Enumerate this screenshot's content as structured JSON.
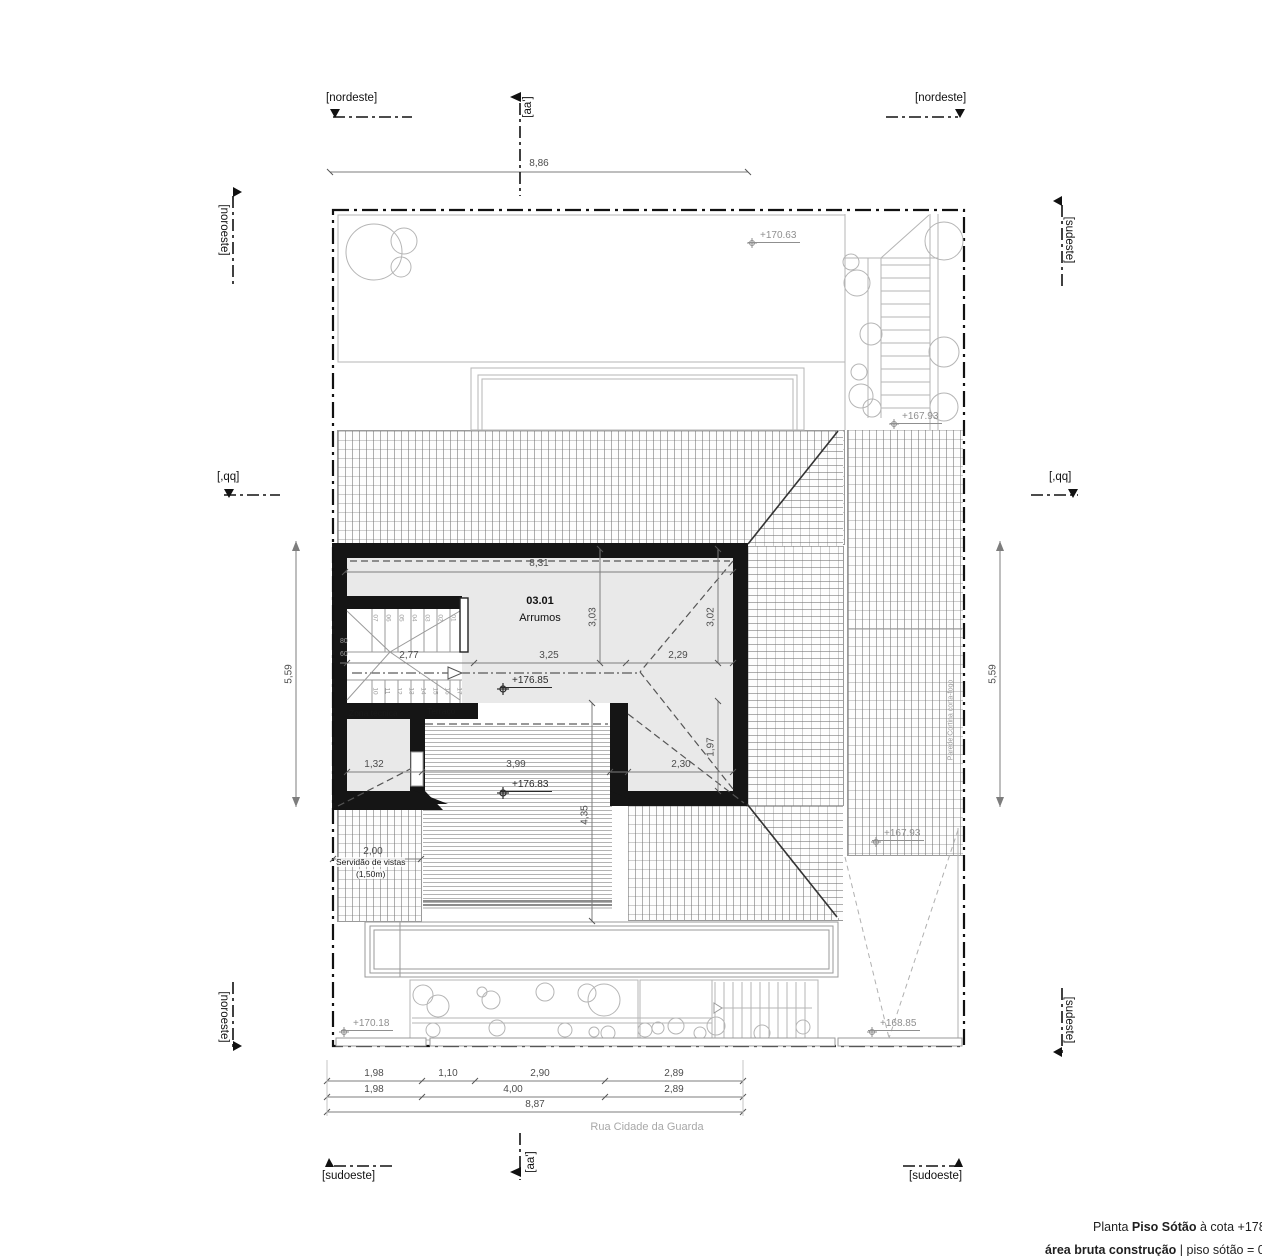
{
  "sections": {
    "nordeste": "[nordeste]",
    "aa": "[aa']",
    "noroeste": "[noroeste]",
    "sudeste": "[sudeste]",
    "qq": "[,qq]",
    "sudoeste": "[sudoeste]"
  },
  "rooms": {
    "number": "03.01",
    "name": "Arrumos",
    "zona": "Zona técnica",
    "terraco": "Terraço",
    "servidao_line1": "Servidão de vistas",
    "servidao_line2": "(1,50m)",
    "firewall": "Parede Cortina corta-fogo"
  },
  "levels": {
    "garden_top": "+170.63",
    "stair_right": "+167.93",
    "attic": "+176.85",
    "terrace": "+176.83",
    "ramp_top": "+167.93",
    "garden_bottom": "+170.18",
    "ramp_bottom": "+168.85"
  },
  "dimensions": {
    "site_width": "8,86",
    "side_left": "5,59",
    "side_right": "5,59",
    "room_width": "8,31",
    "room_depth_left": "3,03",
    "room_depth_right": "3,02",
    "stair_width": "2,77",
    "room_mid": "3,25",
    "room_right": "2,29",
    "zona": "1,32",
    "terrace_width": "3,99",
    "lower_right": "2,30",
    "lower_right_depth": "1,97",
    "terrace_depth": "4,35",
    "servidao": "2,00",
    "b1a": "1,98",
    "b1b": "1,10",
    "b1c": "2,90",
    "b1d": "2,89",
    "b2a": "1,98",
    "b2b": "4,00",
    "b2c": "2,89",
    "b_total": "8,87",
    "stair_rise": "80",
    "stair_going": "60"
  },
  "stair": {
    "upper": [
      "07",
      "06",
      "05",
      "04",
      "03",
      "02",
      "01"
    ],
    "lower": [
      "10",
      "11",
      "12",
      "13",
      "14",
      "15",
      "16",
      "17"
    ]
  },
  "street": "Rua Cidade da Guarda",
  "footer": {
    "prefix": "Planta ",
    "name": "Piso Sótão",
    "suffix": " à cota +178,",
    "line2_bold": "área bruta construção",
    "line2_rest": " | piso sótão = 031"
  }
}
